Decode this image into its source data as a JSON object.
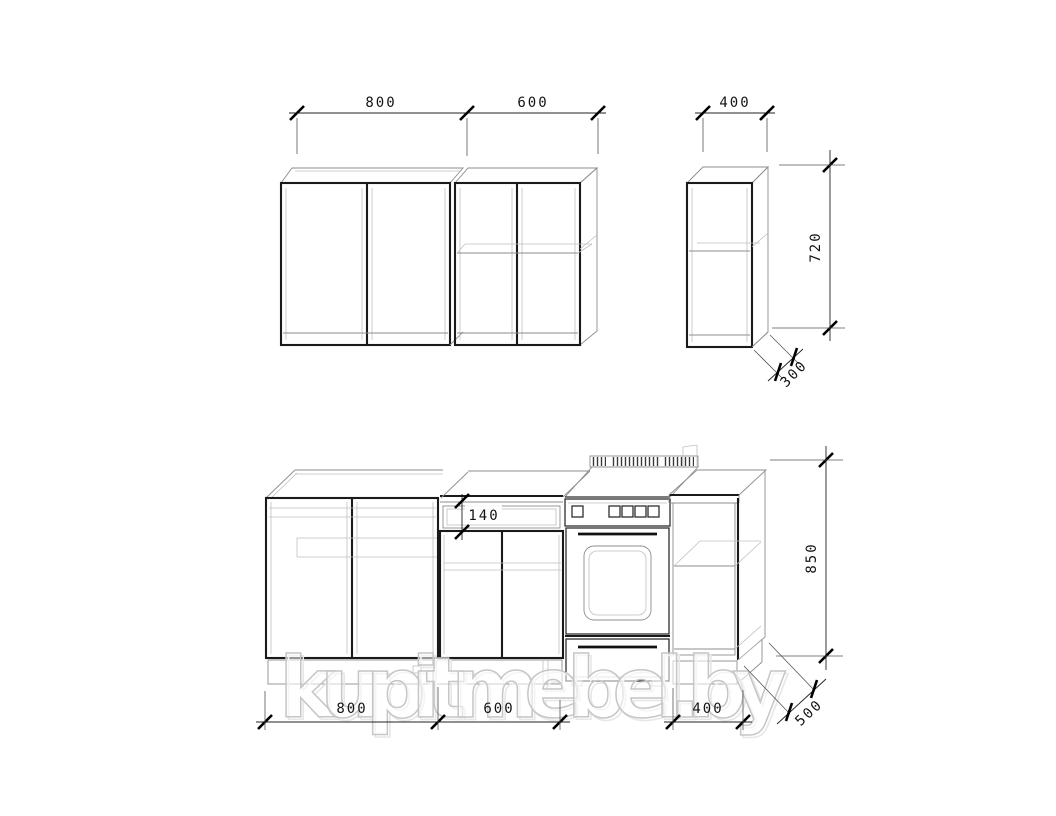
{
  "watermark": {
    "text": "kupitmebel.by"
  },
  "dims": {
    "upper": {
      "width_left": "800",
      "width_right": "600",
      "width_single": "400",
      "height": "720",
      "depth": "300"
    },
    "lower": {
      "width_left": "800",
      "width_mid": "600",
      "width_right": "400",
      "height": "850",
      "depth": "500",
      "drawer_front": "140"
    }
  },
  "colors": {
    "background": "#ffffff",
    "thick_line": "#1a1a1a",
    "thin_line": "#8d8d8d",
    "light_line": "#bfbfbf",
    "dim_text": "#141414",
    "watermark_stroke": "#c6c6c6"
  }
}
